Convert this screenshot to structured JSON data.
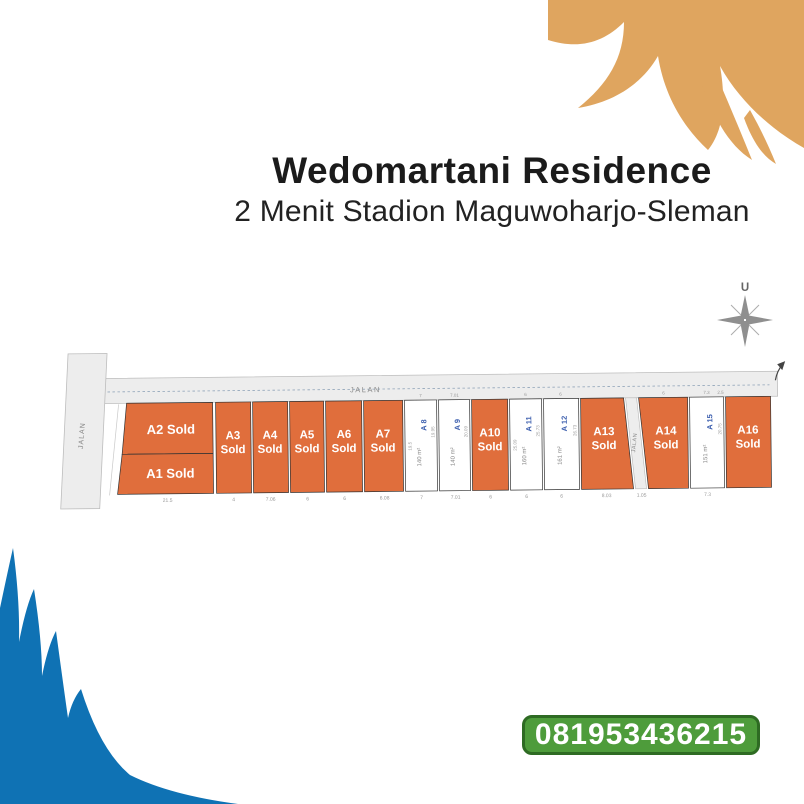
{
  "header": {
    "title": "Wedomartani Residence",
    "subtitle": "2 Menit Stadion Maguwoharjo-Sleman"
  },
  "compass": {
    "label": "U"
  },
  "contact": {
    "phone": "081953436215"
  },
  "roads": {
    "top": "JALAN",
    "left": "JALAN",
    "middle": "JALAN"
  },
  "colors": {
    "sold": "#E06E3C",
    "available": "#FFFFFF",
    "road": "#EDEDED",
    "road_border": "#BDBDBD",
    "plot_border": "#333333",
    "available_label": "#3D5FAE",
    "area_text": "#888888",
    "dim_text": "#999999",
    "dash_line": "#8FA3B8",
    "wave_top": "#DFA55F",
    "wave_bottom": "#0F72B4",
    "phone_bg": "#4E9C3B",
    "phone_border": "#2E6B23",
    "compass": "#8F8F8F"
  },
  "plan": {
    "label_rows": {
      "two_line": [
        437,
        451
      ],
      "name_y": 425,
      "area_y": 457,
      "bottom_dim_y": 499,
      "top_dim_y": 397
    },
    "plots": [
      {
        "id": "A2",
        "type": "sold",
        "points": [
          [
            127,
            400
          ],
          [
            213,
            400
          ],
          [
            213,
            451
          ],
          [
            122,
            451
          ]
        ],
        "label_lines": [
          "A2 Sold"
        ],
        "lx": 171,
        "ly": [
          431
        ],
        "fs": 13
      },
      {
        "id": "A1",
        "type": "sold",
        "points": [
          [
            122,
            451
          ],
          [
            213,
            451
          ],
          [
            213,
            491
          ],
          [
            117,
            491
          ]
        ],
        "label_lines": [
          "A1 Sold"
        ],
        "lx": 170,
        "ly": [
          475
        ],
        "fs": 13
      },
      {
        "id": "A3",
        "type": "sold",
        "points": [
          [
            216,
            400
          ],
          [
            251,
            400
          ],
          [
            251,
            491
          ],
          [
            216,
            491
          ]
        ],
        "label_lines": [
          "A3",
          "Sold"
        ],
        "lx": 233,
        "fs": 11.5
      },
      {
        "id": "A4",
        "type": "sold",
        "points": [
          [
            253,
            400
          ],
          [
            288,
            400
          ],
          [
            288,
            491
          ],
          [
            253,
            491
          ]
        ],
        "label_lines": [
          "A4",
          "Sold"
        ],
        "lx": 270,
        "fs": 11.5
      },
      {
        "id": "A5",
        "type": "sold",
        "points": [
          [
            290,
            400
          ],
          [
            324,
            400
          ],
          [
            324,
            491
          ],
          [
            290,
            491
          ]
        ],
        "label_lines": [
          "A5",
          "Sold"
        ],
        "lx": 307,
        "fs": 11.5
      },
      {
        "id": "A6",
        "type": "sold",
        "points": [
          [
            326,
            400
          ],
          [
            362,
            400
          ],
          [
            362,
            491
          ],
          [
            326,
            491
          ]
        ],
        "label_lines": [
          "A6",
          "Sold"
        ],
        "lx": 344,
        "fs": 11.5
      },
      {
        "id": "A7",
        "type": "sold",
        "points": [
          [
            364,
            400
          ],
          [
            403,
            400
          ],
          [
            403,
            491
          ],
          [
            364,
            491
          ]
        ],
        "label_lines": [
          "A7",
          "Sold"
        ],
        "lx": 383,
        "fs": 11.5
      },
      {
        "id": "A8",
        "type": "available",
        "points": [
          [
            405,
            400
          ],
          [
            437,
            400
          ],
          [
            437,
            491
          ],
          [
            405,
            491
          ]
        ],
        "name": "A 8",
        "area": "140 m²",
        "ldim": "19.5",
        "rdim": "19.95"
      },
      {
        "id": "A9",
        "type": "available",
        "points": [
          [
            439,
            400
          ],
          [
            470,
            400
          ],
          [
            470,
            491
          ],
          [
            439,
            491
          ]
        ],
        "name": "A 9",
        "area": "140 m²",
        "rdim": "20.09"
      },
      {
        "id": "A10",
        "type": "sold",
        "points": [
          [
            472,
            400
          ],
          [
            508,
            400
          ],
          [
            508,
            491
          ],
          [
            472,
            491
          ]
        ],
        "label_lines": [
          "A10",
          "Sold"
        ],
        "lx": 490,
        "fs": 11.5
      },
      {
        "id": "A11",
        "type": "available",
        "points": [
          [
            510,
            400
          ],
          [
            542,
            400
          ],
          [
            542,
            491
          ],
          [
            510,
            491
          ]
        ],
        "name": "A 11",
        "area": "160 m²",
        "ldim": "25.09",
        "rdim": "25.73"
      },
      {
        "id": "A12",
        "type": "available",
        "points": [
          [
            544,
            400
          ],
          [
            579,
            400
          ],
          [
            579,
            491
          ],
          [
            544,
            491
          ]
        ],
        "name": "A 12",
        "area": "161 m²",
        "rdim": "26.73"
      },
      {
        "id": "A13",
        "type": "sold",
        "points": [
          [
            581,
            400
          ],
          [
            624,
            400
          ],
          [
            633,
            491
          ],
          [
            581,
            491
          ]
        ],
        "label_lines": [
          "A13",
          "Sold"
        ],
        "lx": 604,
        "fs": 11.5
      },
      {
        "id": "JALAN-STRIP",
        "type": "road",
        "points": [
          [
            626,
            400
          ],
          [
            637,
            400
          ],
          [
            646,
            491
          ],
          [
            635,
            491
          ]
        ],
        "label": "JALAN"
      },
      {
        "id": "A14",
        "type": "sold",
        "points": [
          [
            639,
            400
          ],
          [
            688,
            400
          ],
          [
            688,
            491
          ],
          [
            648,
            491
          ]
        ],
        "label_lines": [
          "A14",
          "Sold"
        ],
        "lx": 666,
        "fs": 11.5
      },
      {
        "id": "A15",
        "type": "available",
        "points": [
          [
            690,
            400
          ],
          [
            724,
            400
          ],
          [
            724,
            491
          ],
          [
            690,
            491
          ]
        ],
        "name": "A 15",
        "area": "151 m²",
        "rdim": "20.75"
      },
      {
        "id": "A16",
        "type": "sold",
        "points": [
          [
            726,
            400
          ],
          [
            771,
            400
          ],
          [
            771,
            491
          ],
          [
            726,
            491
          ]
        ],
        "label_lines": [
          "A16",
          "Sold"
        ],
        "lx": 748,
        "fs": 11.5
      }
    ],
    "bottom_dims": [
      {
        "t": "21.5",
        "x": 167
      },
      {
        "t": "4",
        "x": 233
      },
      {
        "t": "7.06",
        "x": 270
      },
      {
        "t": "6",
        "x": 307
      },
      {
        "t": "6",
        "x": 344
      },
      {
        "t": "6.08",
        "x": 384
      },
      {
        "t": "7",
        "x": 421
      },
      {
        "t": "7.01",
        "x": 455
      },
      {
        "t": "6",
        "x": 490
      },
      {
        "t": "6",
        "x": 526
      },
      {
        "t": "6",
        "x": 561
      },
      {
        "t": "8.03",
        "x": 606
      },
      {
        "t": "1.05",
        "x": 641
      },
      {
        "t": "7.3",
        "x": 707
      }
    ],
    "top_dims": [
      {
        "t": "7",
        "x": 421
      },
      {
        "t": "7.01",
        "x": 455
      },
      {
        "t": "6",
        "x": 526
      },
      {
        "t": "6",
        "x": 561
      },
      {
        "t": "6",
        "x": 664
      },
      {
        "t": "7.3",
        "x": 707
      },
      {
        "t": "2.5",
        "x": 721
      }
    ]
  }
}
